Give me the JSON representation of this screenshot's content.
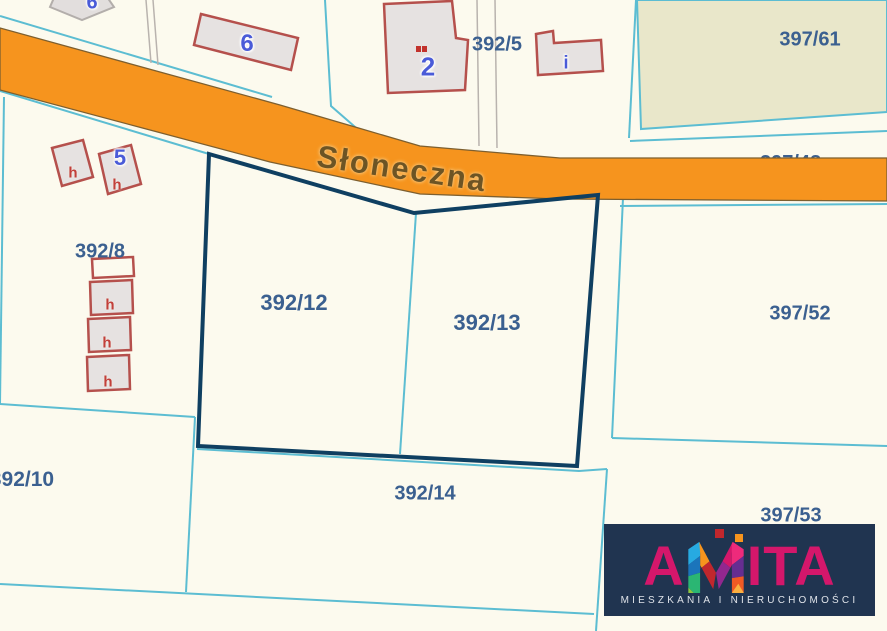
{
  "street_label": "Słoneczna",
  "parcel_labels": {
    "p392_5": "392/5",
    "p397_61": "397/61",
    "p392_8": "392/8",
    "p392_12": "392/12",
    "p392_13": "392/13",
    "p397_52": "397/52",
    "p392_10": "392/10",
    "p392_14": "392/14",
    "p397_53": "397/53",
    "p397_48_partial": "397/48"
  },
  "selected_parcels": [
    "392/12",
    "392/13"
  ],
  "building_labels": {
    "six_topleft": "6",
    "six": "6",
    "two": "2",
    "five": "5",
    "i": "i",
    "six_road_partial": "6",
    "h": "h"
  },
  "logo": {
    "word_a": "A",
    "word_m": "M",
    "word_ita": "ITA",
    "tagline": "MIESZKANIA I NIERUCHOMOŚCI"
  },
  "colors": {
    "map_background": "#fcfaee",
    "road_orange": "#f6941e",
    "road_edge_brown": "#7d5f2f",
    "boundary_teal": "#5cbdd2",
    "selection_navy": "#0f3f61",
    "parcel_label_blue": "#3b6090",
    "olive_parcel_fill": "#e9e7ca",
    "building_outline_red": "#b5504c",
    "building_fill_gray": "#e6e2e1",
    "house_number_blue": "#4a5bd8",
    "house_mark_red": "#c2403a",
    "street_text_brown": "#6d5424",
    "utility_line_gray": "#b9b3ae",
    "logo_background_navy": "#203450",
    "logo_magenta": "#d4176b",
    "logo_tagline_white": "#dfe3e9"
  }
}
